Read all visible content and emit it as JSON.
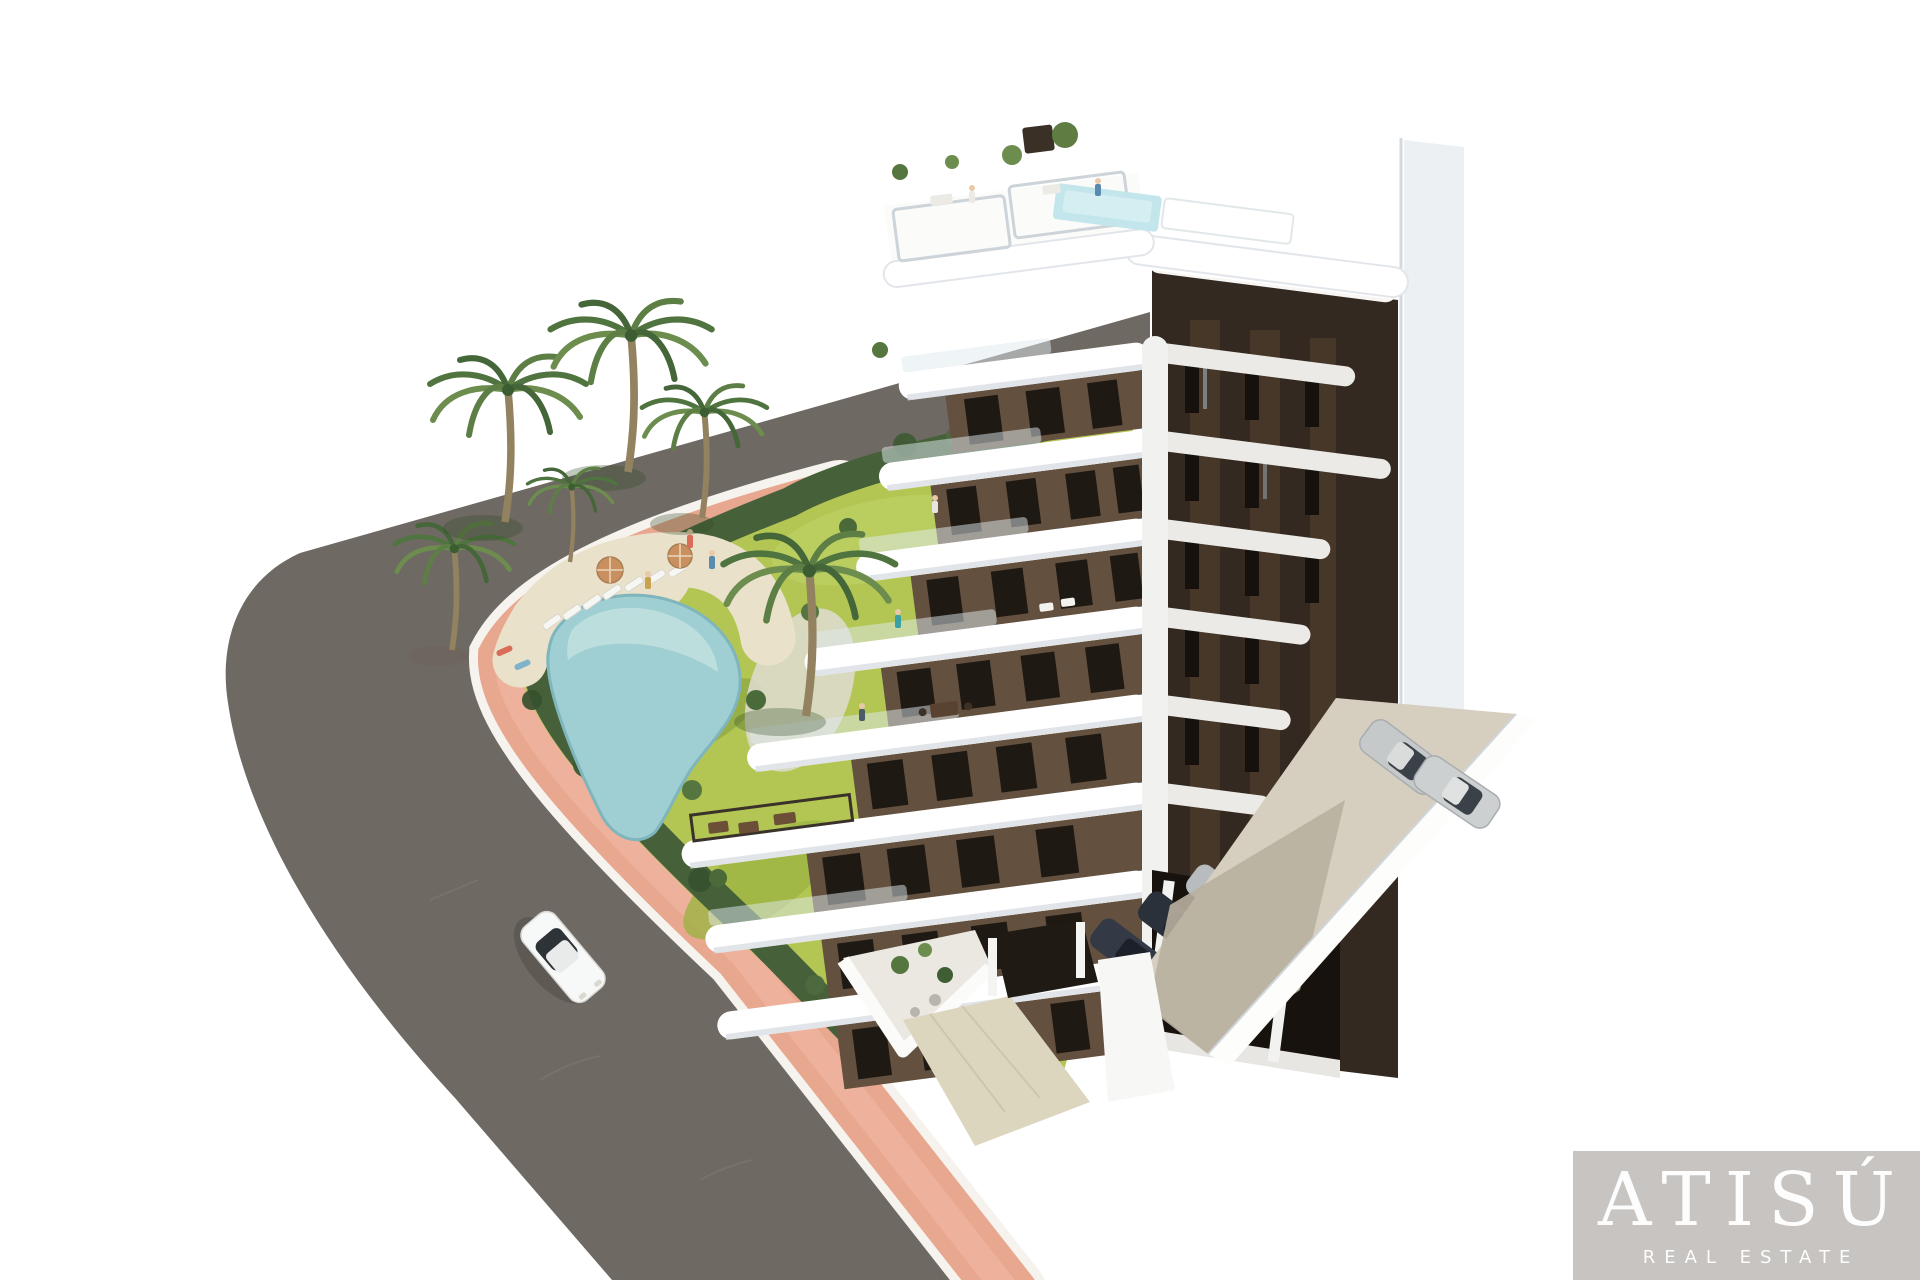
{
  "meta": {
    "type": "architectural-3d-render",
    "view": "aerial bird's-eye"
  },
  "brand": {
    "name": "ATISÚ",
    "tagline": "REAL ESTATE"
  },
  "colors": {
    "background": "#ffffff",
    "road": "#6f6963",
    "sidewalk": "#e8a78f",
    "sidewalk_highlight": "#f2bca7",
    "curb": "#f6f3ee",
    "grass": "#b3c653",
    "grass_light": "#c8d872",
    "hedge": "#46603a",
    "palm_trunk": "#93825f",
    "pool_water": "#9fcfd3",
    "pool_deck": "#e9e1ca",
    "building_white": "#ffffff",
    "building_shadow": "#dde2e7",
    "facade_brown": "#63503f",
    "facade_dark": "#332920",
    "window_dark": "#1f1913",
    "rooftop_pool": "#c2e6ec",
    "concrete": "#d6cfbf",
    "concrete_shadow": "#b9b0a0",
    "entry_paving": "#ddd6bf",
    "gravel_terrace": "#eae8e0",
    "car_white": "#f7f8f8",
    "car_silver": "#c6c9ca",
    "car_dark": "#333a45",
    "logo_background": "#c7c4c1",
    "logo_text": "#fdfdfd"
  },
  "scene": {
    "description": "Bird's-eye 3D rendering of a modern white-and-brown multi-storey apartment building with stepped balconies, rooftop terraces and rooftop pool, landscaped garden with free-form swimming pool, sun loungers, parasols and palm trees, a curved asphalt road with a white car, a pink pedestrian sidewalk with hedge border, a gated entrance and an open-air parking court with cars.",
    "counts": {
      "palm_trees": 6,
      "sun_loungers": 7,
      "parasols": 2,
      "cars_on_road": 1,
      "cars_open_parking": 2,
      "cars_covered_parking": 4,
      "people": 9
    },
    "features": [
      "rooftop pool",
      "rooftop terraces",
      "free-form garden pool",
      "sun deck",
      "curved road",
      "pink sidewalk",
      "hedge border",
      "gated entrance",
      "open-air parking"
    ]
  }
}
